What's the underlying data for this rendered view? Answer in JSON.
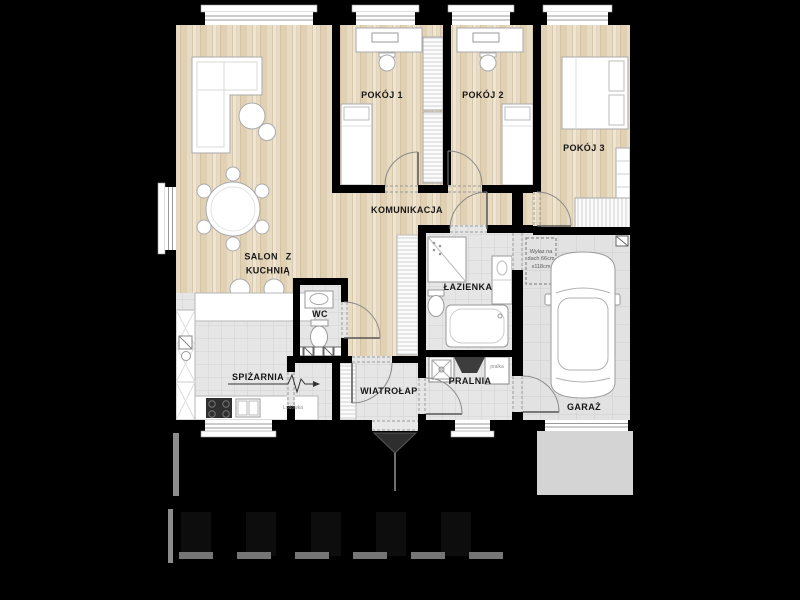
{
  "plan": {
    "type": "floor-plan",
    "colors": {
      "background": "#000000",
      "wall": "#000000",
      "wood_floor": "#e8dbc4",
      "tile_floor": "#e6e6e6",
      "garage_tile": "#e2e2e2",
      "driveway": "#d4d4d4"
    }
  },
  "rooms": {
    "salon": {
      "label": "SALON Z\nKUCHNIĄ"
    },
    "pokoj1": {
      "label": "POKÓJ 1"
    },
    "pokoj2": {
      "label": "POKÓJ 2"
    },
    "pokoj3": {
      "label": "POKÓJ 3"
    },
    "komunikacja": {
      "label": "KOMUNIKACJA"
    },
    "wc": {
      "label": "WC"
    },
    "lazienka": {
      "label": "ŁAZIENKA"
    },
    "spizarnia": {
      "label": "SPIŻARNIA"
    },
    "wiatrolap": {
      "label": "WIATROŁAP"
    },
    "pralnia": {
      "label": "PRALNIA"
    },
    "garaz": {
      "label": "GARAŻ"
    }
  },
  "annotations": {
    "washer": "pralka",
    "fridge": "Lodówka",
    "roof_hatch": "Wyłaz na dach 66cm x118cm"
  }
}
